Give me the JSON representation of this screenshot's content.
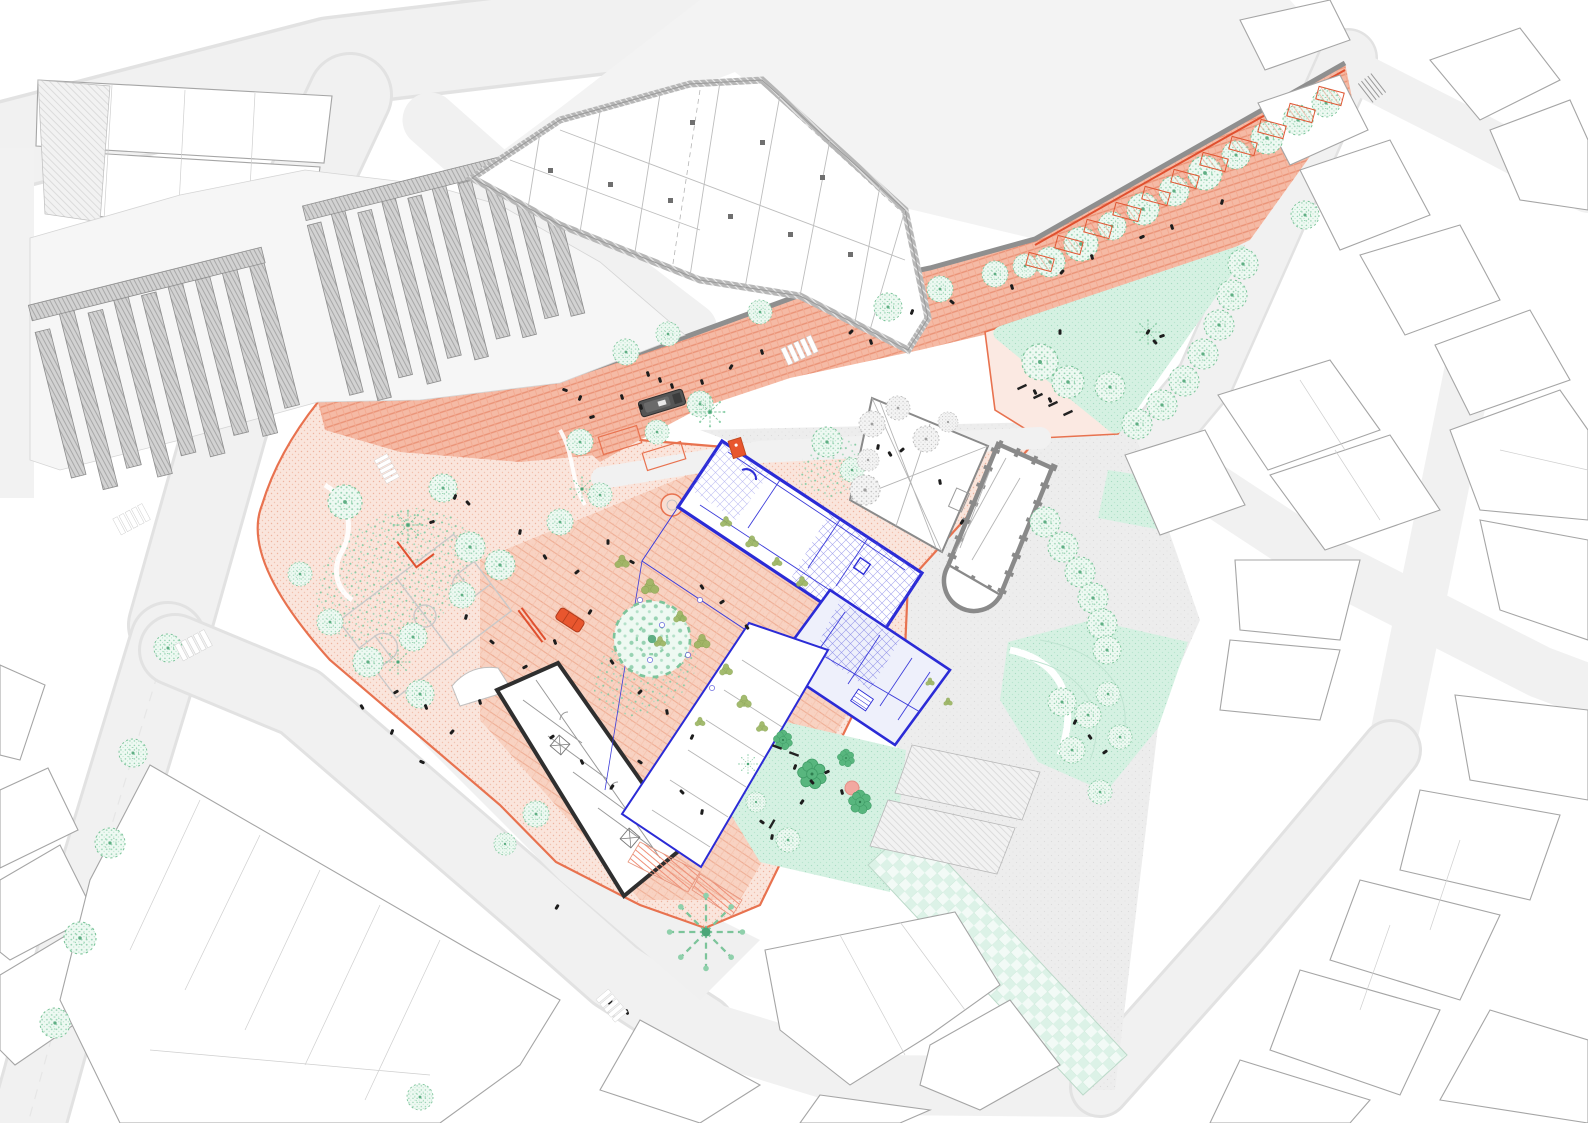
{
  "colors": {
    "background": "#ffffff",
    "road_fill": "#f1f1f1",
    "road_edge": "#e0e0e0",
    "building_fill": "#ffffff",
    "building_stroke": "#a5a5a5",
    "block_hatch": "#c9c9c9",
    "complex_wall": "#b6b6b6",
    "retaining_wall": "#8f8f8f",
    "accent_red": "#e0502f",
    "plaza_border": "#e8724f",
    "plaza_light": "#fae5dc",
    "plaza_street": "#f5baa5",
    "plaza_mid": "#f8cfbd",
    "mint": "#d5f1e2",
    "tree_green": "#97d2b2",
    "tree_dark": "#55b47c",
    "olive": "#9ab45f",
    "paving_gray": "#ededed",
    "proposal_blue": "#2b2bd6",
    "existing_black": "#2f2f2f",
    "vehicle_gray": "#555555",
    "car_orange": "#e8562e",
    "people_black": "#1d1d1d",
    "pink_dot": "#f2a8a0"
  },
  "features": [
    {
      "name": "pedestrian-plaza",
      "color_ref": "plaza_light"
    },
    {
      "name": "paved-street-band",
      "color_ref": "plaza_street"
    },
    {
      "name": "proposed-building",
      "color_ref": "proposal_blue"
    },
    {
      "name": "existing-building",
      "color_ref": "existing_black"
    },
    {
      "name": "church",
      "color_ref": "retaining_wall"
    },
    {
      "name": "park-lawn",
      "color_ref": "mint"
    },
    {
      "name": "context-buildings",
      "color_ref": "building_stroke"
    }
  ],
  "map": {
    "stamps": [
      [
        "tree-a",
        1050,
        262,
        1.5,
        0
      ],
      [
        "tree-a",
        1081,
        244,
        1.7,
        0
      ],
      [
        "tree-a",
        1112,
        226,
        1.4,
        0
      ],
      [
        "tree-a",
        1143,
        209,
        1.6,
        0
      ],
      [
        "tree-a",
        1174,
        191,
        1.5,
        0
      ],
      [
        "tree-a",
        1205,
        173,
        1.7,
        0
      ],
      [
        "tree-a",
        1236,
        155,
        1.4,
        0
      ],
      [
        "tree-a",
        1267,
        138,
        1.6,
        0
      ],
      [
        "tree-a",
        1298,
        120,
        1.5,
        0
      ],
      [
        "tree-a",
        1326,
        103,
        1.4,
        0
      ],
      [
        "tree-a",
        626,
        352,
        1.3,
        0
      ],
      [
        "tree-a",
        668,
        334,
        1.2,
        0
      ],
      [
        "tree-a",
        760,
        312,
        1.2,
        0
      ],
      [
        "tree-a",
        888,
        307,
        1.4,
        0
      ],
      [
        "tree-a",
        940,
        289,
        1.3,
        0
      ],
      [
        "tree-a",
        995,
        274,
        1.3,
        0
      ],
      [
        "tree-a",
        1025,
        266,
        1.2,
        0
      ],
      [
        "tree-a",
        1243,
        264,
        1.5,
        0
      ],
      [
        "tree-a",
        1232,
        295,
        1.5,
        0
      ],
      [
        "tree-a",
        1219,
        325,
        1.5,
        0
      ],
      [
        "tree-a",
        1203,
        354,
        1.5,
        0
      ],
      [
        "tree-a",
        1184,
        381,
        1.5,
        0
      ],
      [
        "tree-a",
        1162,
        405,
        1.5,
        0
      ],
      [
        "tree-a",
        1137,
        424,
        1.5,
        0
      ],
      [
        "tree-a",
        1040,
        362,
        1.8,
        0
      ],
      [
        "tree-a",
        1068,
        382,
        1.6,
        0
      ],
      [
        "tree-a",
        1110,
        387,
        1.5,
        0
      ],
      [
        "tree-a",
        1045,
        522,
        1.5,
        0
      ],
      [
        "tree-a",
        1063,
        547,
        1.5,
        0
      ],
      [
        "tree-a",
        1080,
        572,
        1.5,
        0
      ],
      [
        "tree-a",
        1093,
        598,
        1.5,
        0
      ],
      [
        "tree-a",
        1102,
        624,
        1.5,
        0
      ],
      [
        "tree-a",
        1107,
        650,
        1.4,
        0
      ],
      [
        "tree-a",
        345,
        502,
        1.7,
        0
      ],
      [
        "tree-a",
        443,
        488,
        1.4,
        0
      ],
      [
        "tree-a",
        470,
        547,
        1.5,
        0
      ],
      [
        "tree-a",
        500,
        565,
        1.5,
        0
      ],
      [
        "tree-a",
        462,
        595,
        1.3,
        0
      ],
      [
        "tree-a",
        413,
        637,
        1.4,
        0
      ],
      [
        "tree-a",
        300,
        574,
        1.2,
        0
      ],
      [
        "tree-a",
        330,
        622,
        1.3,
        0
      ],
      [
        "tree-a",
        368,
        662,
        1.5,
        0
      ],
      [
        "tree-a",
        420,
        694,
        1.4,
        0
      ],
      [
        "tree-a",
        536,
        814,
        1.3,
        0
      ],
      [
        "tree-a",
        505,
        844,
        1.1,
        0
      ],
      [
        "tree-a",
        560,
        522,
        1.3,
        0
      ],
      [
        "tree-a",
        700,
        404,
        1.3,
        0
      ],
      [
        "tree-a",
        657,
        432,
        1.2,
        0
      ],
      [
        "tree-a",
        580,
        442,
        1.3,
        0
      ],
      [
        "tree-a",
        600,
        495,
        1.2,
        0
      ],
      [
        "tree-a",
        827,
        442,
        1.5,
        0
      ],
      [
        "tree-a",
        852,
        470,
        1.2,
        0
      ],
      [
        "tree-a",
        652,
        639,
        3.8,
        0
      ],
      [
        "tree-a",
        133,
        753,
        1.4,
        0
      ],
      [
        "tree-a",
        110,
        843,
        1.5,
        0
      ],
      [
        "tree-a",
        80,
        938,
        1.6,
        0
      ],
      [
        "tree-a",
        55,
        1023,
        1.5,
        0
      ],
      [
        "tree-a",
        168,
        648,
        1.4,
        0
      ],
      [
        "tree-a",
        420,
        1097,
        1.3,
        0
      ],
      [
        "tree-a",
        1305,
        215,
        1.4,
        0
      ],
      [
        "tree-a",
        1062,
        702,
        1.4,
        0
      ],
      [
        "tree-a",
        1088,
        715,
        1.3,
        0
      ],
      [
        "tree-a",
        1072,
        750,
        1.3,
        0
      ],
      [
        "tree-a",
        1108,
        694,
        1.2,
        0
      ],
      [
        "tree-a",
        1120,
        737,
        1.2,
        0
      ],
      [
        "tree-a",
        1100,
        792,
        1.2,
        0
      ],
      [
        "tree-a",
        788,
        840,
        1.2,
        0
      ],
      [
        "tree-a",
        756,
        802,
        1.0,
        0
      ],
      [
        "tree-b",
        812,
        774,
        1.5,
        0
      ],
      [
        "tree-b",
        860,
        802,
        1.2,
        0
      ],
      [
        "tree-b",
        783,
        740,
        1.0,
        0
      ],
      [
        "tree-b",
        846,
        758,
        0.9,
        0
      ],
      [
        "tree-c",
        408,
        525,
        1.1,
        0
      ],
      [
        "tree-c",
        398,
        662,
        0.9,
        0
      ],
      [
        "tree-c",
        582,
        489,
        0.9,
        0
      ],
      [
        "tree-c",
        710,
        412,
        1.1,
        0
      ],
      [
        "tree-c",
        748,
        764,
        0.7,
        0
      ],
      [
        "tree-c",
        1148,
        332,
        0.9,
        0
      ],
      [
        "tree-c",
        706,
        932,
        2.8,
        0
      ],
      [
        "tree-d",
        872,
        424,
        1.3,
        0
      ],
      [
        "tree-d",
        898,
        408,
        1.2,
        0
      ],
      [
        "tree-d",
        926,
        439,
        1.3,
        0
      ],
      [
        "tree-d",
        868,
        460,
        1.1,
        0
      ],
      [
        "tree-d",
        948,
        422,
        1.0,
        0
      ],
      [
        "tree-d",
        865,
        490,
        1.5,
        0
      ],
      [
        "tree-e",
        622,
        562,
        1.0,
        0
      ],
      [
        "tree-e",
        650,
        587,
        1.2,
        0
      ],
      [
        "tree-e",
        680,
        617,
        0.9,
        0
      ],
      [
        "tree-e",
        702,
        642,
        1.1,
        0
      ],
      [
        "tree-e",
        726,
        670,
        0.9,
        0
      ],
      [
        "tree-e",
        744,
        702,
        1.0,
        0
      ],
      [
        "tree-e",
        762,
        727,
        0.8,
        0
      ],
      [
        "tree-e",
        700,
        722,
        0.7,
        0
      ],
      [
        "tree-e",
        660,
        642,
        0.8,
        0
      ],
      [
        "tree-e",
        726,
        522,
        0.8,
        0
      ],
      [
        "tree-e",
        752,
        542,
        0.9,
        0
      ],
      [
        "tree-e",
        777,
        562,
        0.7,
        0
      ],
      [
        "tree-e",
        802,
        582,
        0.8,
        0
      ],
      [
        "tree-e",
        930,
        682,
        0.6,
        0
      ],
      [
        "tree-e",
        948,
        702,
        0.6,
        0
      ],
      [
        "table",
        640,
        600,
        1,
        0
      ],
      [
        "table",
        662,
        625,
        1,
        0
      ],
      [
        "table",
        688,
        655,
        1,
        0
      ],
      [
        "table",
        712,
        688,
        1,
        0
      ],
      [
        "table",
        650,
        660,
        1,
        0
      ],
      [
        "table",
        700,
        600,
        1,
        0
      ],
      [
        "person",
        455,
        497,
        1,
        20
      ],
      [
        "person",
        468,
        503,
        1,
        -40
      ],
      [
        "person",
        432,
        522,
        1,
        70
      ],
      [
        "person",
        520,
        532,
        1,
        10
      ],
      [
        "person",
        545,
        557,
        1,
        -30
      ],
      [
        "person",
        577,
        572,
        1,
        50
      ],
      [
        "person",
        608,
        542,
        1,
        0
      ],
      [
        "person",
        632,
        562,
        1,
        -60
      ],
      [
        "person",
        590,
        612,
        1,
        30
      ],
      [
        "person",
        555,
        642,
        1,
        -20
      ],
      [
        "person",
        525,
        667,
        1,
        60
      ],
      [
        "person",
        492,
        642,
        1,
        -50
      ],
      [
        "person",
        466,
        617,
        1,
        15
      ],
      [
        "person",
        612,
        662,
        1,
        -35
      ],
      [
        "person",
        640,
        692,
        1,
        45
      ],
      [
        "person",
        667,
        712,
        1,
        -10
      ],
      [
        "person",
        692,
        737,
        1,
        25
      ],
      [
        "person",
        640,
        762,
        1,
        -55
      ],
      [
        "person",
        612,
        787,
        1,
        35
      ],
      [
        "person",
        582,
        762,
        1,
        -25
      ],
      [
        "person",
        552,
        737,
        1,
        55
      ],
      [
        "person",
        682,
        792,
        1,
        -45
      ],
      [
        "person",
        702,
        812,
        1,
        10
      ],
      [
        "person",
        480,
        702,
        1,
        -15
      ],
      [
        "person",
        452,
        732,
        1,
        40
      ],
      [
        "person",
        422,
        762,
        1,
        -65
      ],
      [
        "person",
        392,
        732,
        1,
        20
      ],
      [
        "person",
        362,
        707,
        1,
        -30
      ],
      [
        "person",
        396,
        692,
        1,
        60
      ],
      [
        "person",
        426,
        707,
        1,
        -20
      ],
      [
        "person",
        622,
        397,
        1,
        -17
      ],
      [
        "person",
        641,
        407,
        1,
        -17
      ],
      [
        "person",
        592,
        417,
        1,
        73
      ],
      [
        "person",
        702,
        382,
        1,
        -17
      ],
      [
        "person",
        731,
        367,
        1,
        30
      ],
      [
        "person",
        762,
        352,
        1,
        -17
      ],
      [
        "person",
        851,
        332,
        1,
        45
      ],
      [
        "person",
        871,
        342,
        1,
        -17
      ],
      [
        "person",
        912,
        312,
        1,
        20
      ],
      [
        "person",
        952,
        302,
        1,
        -50
      ],
      [
        "person",
        1012,
        287,
        1,
        -17
      ],
      [
        "person",
        1062,
        272,
        1,
        40
      ],
      [
        "person",
        1092,
        257,
        1,
        -17
      ],
      [
        "person",
        1142,
        237,
        1,
        65
      ],
      [
        "person",
        1172,
        227,
        1,
        -17
      ],
      [
        "person",
        1222,
        202,
        1,
        15
      ],
      [
        "person",
        565,
        390,
        1,
        -70
      ],
      [
        "person",
        580,
        398,
        1,
        20
      ],
      [
        "person",
        1148,
        332,
        1,
        30
      ],
      [
        "person",
        1155,
        342,
        1,
        -40
      ],
      [
        "person",
        1162,
        336,
        1,
        70
      ],
      [
        "person",
        1060,
        332,
        1,
        0
      ],
      [
        "person",
        1035,
        392,
        1,
        -25
      ],
      [
        "person",
        1050,
        400,
        1,
        -25
      ],
      [
        "person",
        878,
        447,
        1,
        10
      ],
      [
        "person",
        890,
        454,
        1,
        -30
      ],
      [
        "person",
        902,
        450,
        1,
        50
      ],
      [
        "person",
        940,
        482,
        1,
        -10
      ],
      [
        "person",
        962,
        522,
        1,
        30
      ],
      [
        "person",
        795,
        767,
        1,
        20
      ],
      [
        "person",
        812,
        782,
        1,
        -40
      ],
      [
        "person",
        827,
        772,
        1,
        65
      ],
      [
        "person",
        842,
        792,
        1,
        -15
      ],
      [
        "person",
        802,
        802,
        1,
        35
      ],
      [
        "person",
        762,
        822,
        1,
        -55
      ],
      [
        "person",
        772,
        837,
        1,
        10
      ],
      [
        "person",
        1075,
        722,
        1,
        25
      ],
      [
        "person",
        1090,
        737,
        1,
        -35
      ],
      [
        "person",
        1105,
        752,
        1,
        55
      ],
      [
        "person",
        610,
        1002,
        1,
        40
      ],
      [
        "person",
        627,
        1012,
        1,
        -20
      ],
      [
        "person",
        557,
        907,
        1,
        30
      ],
      [
        "person",
        702,
        587,
        1,
        -34
      ],
      [
        "person",
        722,
        602,
        1,
        56
      ],
      [
        "person",
        747,
        627,
        1,
        -34
      ],
      [
        "person",
        648,
        374,
        1,
        -17
      ],
      [
        "person",
        660,
        380,
        1,
        -17
      ],
      [
        "person",
        672,
        386,
        1,
        -17
      ],
      [
        "bench",
        1022,
        387,
        1,
        -25
      ],
      [
        "bench",
        1038,
        396,
        1,
        -25
      ],
      [
        "bench",
        1053,
        404,
        1,
        -25
      ],
      [
        "bench",
        1068,
        413,
        1,
        -25
      ],
      [
        "bench",
        777,
        747,
        1,
        20
      ],
      [
        "bench",
        794,
        754,
        1,
        20
      ],
      [
        "bench",
        772,
        824,
        1,
        -60
      ],
      [
        "stall",
        1040,
        262,
        1,
        15
      ],
      [
        "stall",
        1069,
        245,
        1,
        15
      ],
      [
        "stall",
        1098,
        229,
        1,
        15
      ],
      [
        "stall",
        1127,
        212,
        1,
        15
      ],
      [
        "stall",
        1156,
        196,
        1,
        15
      ],
      [
        "stall",
        1185,
        179,
        1,
        15
      ],
      [
        "stall",
        1214,
        162,
        1,
        15
      ],
      [
        "stall",
        1243,
        146,
        1,
        15
      ],
      [
        "stall",
        1272,
        129,
        1,
        15
      ],
      [
        "stall",
        1301,
        113,
        1,
        15
      ],
      [
        "stall",
        1330,
        96,
        1,
        15
      ],
      [
        "crosswalk",
        132,
        519,
        1,
        -28
      ],
      [
        "crosswalk",
        194,
        645,
        1,
        -28
      ],
      [
        "crosswalk",
        387,
        469,
        0.8,
        62
      ],
      [
        "crosswalk",
        800,
        350,
        1,
        -25
      ],
      [
        "crosswalk",
        612,
        1006,
        0.9,
        50
      ]
    ]
  }
}
